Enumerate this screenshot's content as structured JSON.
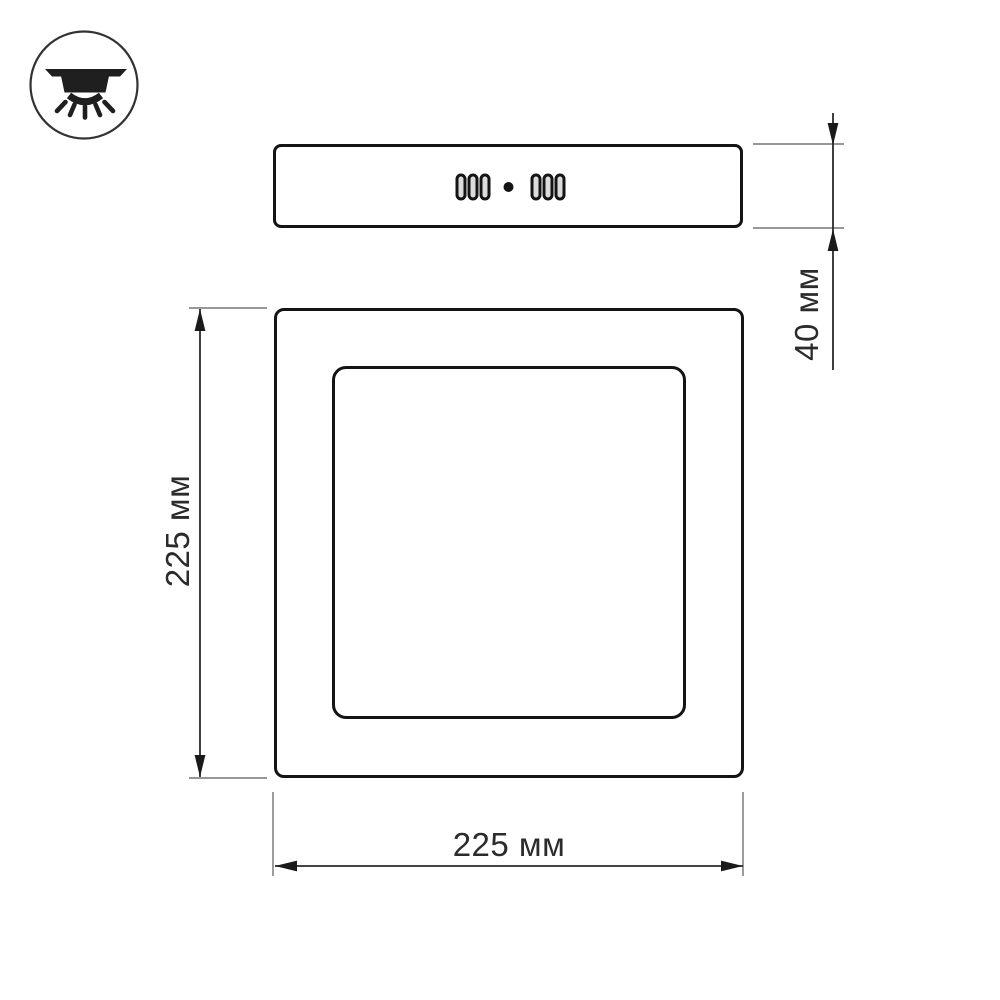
{
  "drawing": {
    "subject": "square ceiling light panel, dimensioned technical drawing",
    "views": {
      "side": {
        "name": "side view",
        "features": [
          "left vent slot group (3 slots)",
          "center dot",
          "right vent slot group (3 slots)"
        ]
      },
      "front": {
        "name": "front view",
        "features": [
          "outer square frame",
          "inner diffuser square"
        ]
      }
    }
  },
  "icon": {
    "name": "ceiling-light-icon"
  },
  "dimensions": {
    "front_height": {
      "label": "225 мм",
      "orientation": "vertical-left"
    },
    "front_width": {
      "label": "225 мм",
      "orientation": "horizontal-bottom"
    },
    "side_depth": {
      "label": "40 мм",
      "orientation": "vertical-right"
    }
  },
  "colors": {
    "background": "#ffffff",
    "outline": "#141414",
    "dimension_line": "#2a2a2a",
    "extension_line": "#8a8a8a",
    "label_text": "#2b2b2b"
  }
}
